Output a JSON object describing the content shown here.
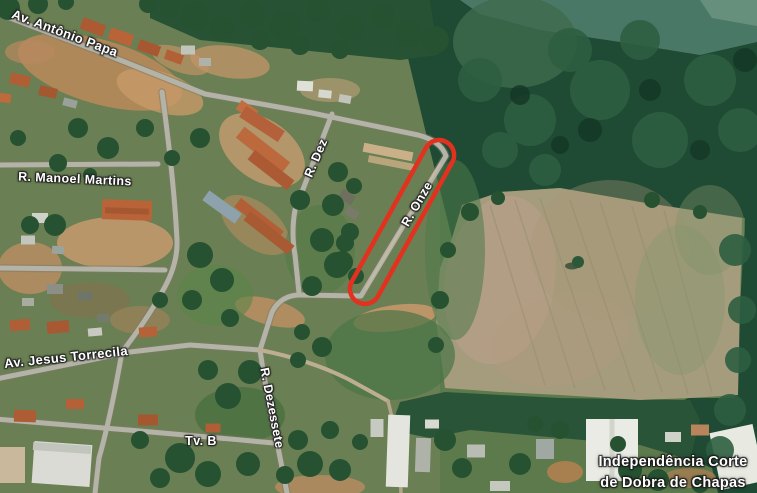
{
  "map": {
    "view": "satellite",
    "labels": {
      "av_antonio_papa": "Av. Antônio Papa",
      "r_manoel_martins": "R. Manoel Martins",
      "r_dez": "R. Dez",
      "r_onze": "R. Onze",
      "av_jesus_torrecila": "Av. Jesus Torrecila",
      "r_dezessete": "R. Dezessete",
      "tv_b": "Tv. B"
    },
    "poi": {
      "name_line1": "Independência Corte",
      "name_line2": "de Dobra de Chapas"
    },
    "annotation": {
      "shape": "red-rounded-oval-outline",
      "color": "#e33120",
      "highlights_street": "R. Onze"
    },
    "colors": {
      "forest_green": "#1f4a33",
      "grass_green": "#5d7a4c",
      "field_tan": "#a59b7d",
      "road_gray": "#b4b3a7",
      "dirt_orange": "#bb8a5c",
      "roof_orange": "#b2603a",
      "label_text": "#ffffff"
    }
  }
}
